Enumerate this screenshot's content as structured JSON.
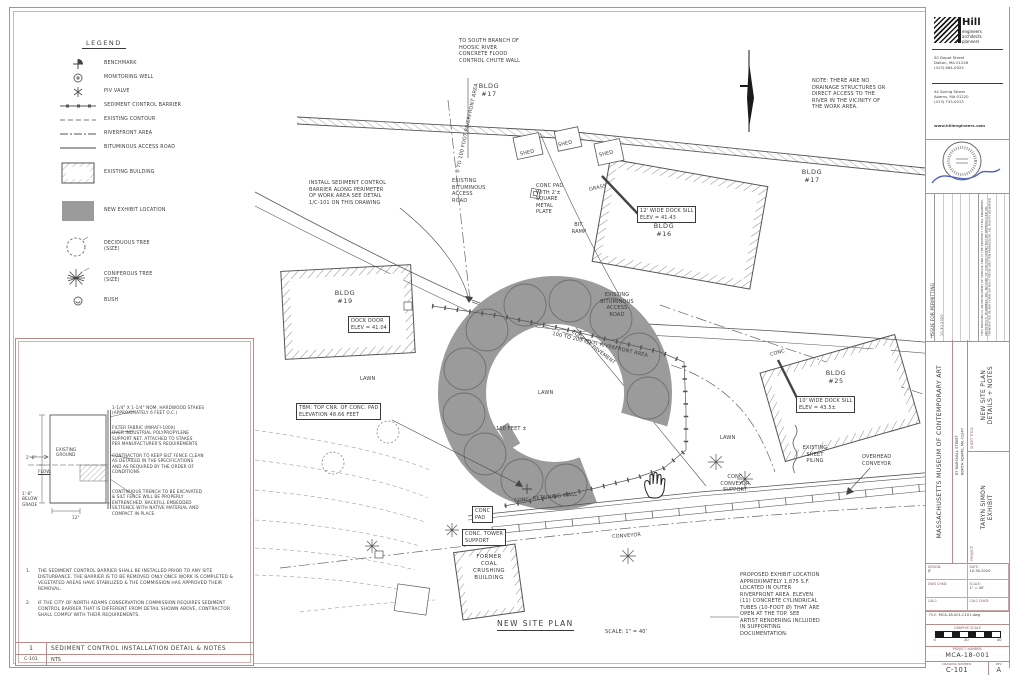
{
  "colors": {
    "frame": "#b98c8c",
    "ink": "#3c3c3c",
    "exhibit_gray": "#9b9b9b",
    "signature_blue": "#4a5fc1"
  },
  "legend": {
    "title": "LEGEND",
    "items": [
      {
        "icon": "benchmark-icon",
        "label": "BENCHMARK"
      },
      {
        "icon": "monitoring-well-icon",
        "label": "MONITORING WELL"
      },
      {
        "icon": "piv-valve-icon",
        "label": "PIV VALVE"
      },
      {
        "icon": "sediment-barrier-icon",
        "label": "SEDIMENT CONTROL BARRIER"
      },
      {
        "icon": "existing-contour-icon",
        "label": "EXISTING CONTOUR"
      },
      {
        "icon": "riverfront-area-icon",
        "label": "RIVERFRONT AREA"
      },
      {
        "icon": "bituminous-road-icon",
        "label": "BITUMINOUS ACCESS ROAD"
      },
      {
        "icon": "existing-building-icon",
        "label": "EXISTING BUILDING"
      },
      {
        "icon": "new-exhibit-icon",
        "label": "NEW EXHIBIT LOCATION"
      },
      {
        "icon": "deciduous-tree-icon",
        "label": "DECIDUOUS TREE\n(SIZE)"
      },
      {
        "icon": "coniferous-tree-icon",
        "label": "CONIFEROUS TREE\n(SIZE)"
      },
      {
        "icon": "bush-icon",
        "label": "BUSH"
      }
    ]
  },
  "plan": {
    "labels": [
      {
        "t": "TO SOUTH BRANCH OF\nHOOSIC RIVER\nCONCRETE FLOOD\nCONTROL CHUTE WALL"
      },
      {
        "t": "BLDG\n#17"
      },
      {
        "t": "NOTE: THERE ARE NO\nDRAINAGE STRUCTURES OR\nDIRECT ACCESS TO THE\nRIVER IN THE VICINITY OF\nTHE WORK AREA."
      },
      {
        "t": "BLDG\n#17"
      },
      {
        "t": "INSTALL SEDIMENT CONTROL\nBARRIER ALONG PERIMETER\nOF WORK AREA SEE DETAIL\n1/C-101 ON THIS DRAWING"
      },
      {
        "t": "0 TO 100 FOOT RIVERFRONT AREA"
      },
      {
        "t": "EXISTING\nBITUMINOUS\nACCESS\nROAD"
      },
      {
        "t": "SHED"
      },
      {
        "t": "SHED"
      },
      {
        "t": "SHED"
      },
      {
        "t": "CONC PAD\nWITH 2'±\nSQUARE\nMETAL\nPLATE"
      },
      {
        "t": "GRASS"
      },
      {
        "t": "BIT.\nRAMP"
      },
      {
        "t": "12' WIDE DOCK SILL\nELEV = 41.43"
      },
      {
        "t": "BLDG\n#16"
      },
      {
        "t": "EXISTING\nBITUMINOUS\nACCESS\nROAD"
      },
      {
        "t": "100 TO 200 FOOT RIVERFRONT AREA"
      },
      {
        "t": "BLDG\n#19"
      },
      {
        "t": "DOCK DOOR\nELEV = 41.04"
      },
      {
        "t": "LAWN"
      },
      {
        "t": "LAWN"
      },
      {
        "t": "LAWN"
      },
      {
        "t": "EDGE OF PAVEMENT"
      },
      {
        "t": "TBM: TOP CNR. OF CONC. PAD\nELEVATION 48.66 FEET"
      },
      {
        "t": "110 FEET ±"
      },
      {
        "t": "CONC"
      },
      {
        "t": "BLDG\n#25"
      },
      {
        "t": "10' WIDE DOCK SILL\nELEV = 43.5±"
      },
      {
        "t": "EXISTING\nSHEET\nPILING"
      },
      {
        "t": "OVERHEAD\nCONVEYOR"
      },
      {
        "t": "CONC\nCONVEYOR\nSUPPORT"
      },
      {
        "t": "CONC. RETAINING WALL"
      },
      {
        "t": "CONC\nPAD"
      },
      {
        "t": "CONC. TOWER\nSUPPORT"
      },
      {
        "t": "FORMER\nCOAL\nCRUSHING\nBUILDING"
      },
      {
        "t": "CONVEYOR"
      },
      {
        "t": "NEW SITE PLAN"
      },
      {
        "t": "SCALE: 1\" = 40'"
      },
      {
        "t": "PROPOSED EXHIBIT LOCATION\nAPPROXIMATELY 1,875 S.F.\nLOCATED IN OUTER\nRIVERFRONT AREA. ELEVEN\n(11) CONCRETE CYLINDRICAL\nTUBES (10-FOOT Ø) THAT ARE\nOPEN AT THE TOP.  SEE\nARTIST RENDERING INCLUDED\nIN SUPPORTING\nDOCUMENTATION."
      }
    ]
  },
  "detail": {
    "callouts": [
      {
        "t": "1-1/4\" X 1-1/4\" NOM. HARDWOOD STAKES\n(APPROXIMATELY 6 FEET O.C.)"
      },
      {
        "t": "FILTER FABRIC (MIRAFI-100X)\nOVER INDUSTRIAL POLYPROPYLENE\nSUPPORT NET. ATTACHED TO STAKES\nPER MANUFACTURER'S REQUIREMENTS"
      },
      {
        "t": "CONTRACTOR TO KEEP SILT FENCE CLEAN\nAS DETAILED IN THE SPECIFICATIONS\nAND AS REQUIRED BY THE ORDER OF\nCONDITIONS"
      },
      {
        "t": "CONTINUOUS TRENCH TO BE EXCAVATED\n& SILT FENCE WILL BE PROPERLY\nENTRENCHED. BACKFILL EMBEDDED\nSILTFENCE WITH NATIVE MATERIAL AND\nCOMPACT IN PLACE."
      }
    ],
    "dims": {
      "height": "2'-6\"",
      "existing_ground": "EXISTING\nGROUND",
      "flow": "FLOW",
      "below_grade": "1'-6\"\nBELOW\nGRADE",
      "width": "12\""
    },
    "notes": [
      {
        "n": "1.",
        "t": "THE SEDIMENT CONTROL BARRIER SHALL BE INSTALLED PRIOR TO ANY SITE DISTURBANCE.  THE BARRIER IS TO BE REMOVED ONLY ONCE WORK IS COMPLETED & VEGETATED AREAS HAVE STABILIZED & THE COMMISSION HAS APPROVED THEIR REMOVAL."
      },
      {
        "n": "2.",
        "t": "IF THE CITY OF NORTH ADAMS CONSERVATION COMMISSION REQUIRES SEDIMENT CONTROL BARRIER THAT IS DIFFERENT FROM DETAIL SHOWN ABOVE, CONTRACTOR SHALL COMPLY WITH THEIR REQUIREMENTS."
      }
    ],
    "footer": {
      "number": "1",
      "title": "SEDIMENT CONTROL INSTALLATION DETAIL & NOTES",
      "ref": "C-101",
      "scale": "NTS"
    }
  },
  "titleblock": {
    "firm": {
      "name": "Hill",
      "tagline": "engineers\narchitects\nplanners",
      "address1": "50 Depot Street\nDalton, MA 01226\n(413) 684-0925",
      "address2": "44 Spring Street\nAdams, MA 01220\n(413) 743-0013",
      "website": "www.hillengineers.com"
    },
    "revisions": {
      "number": "1",
      "date": "10-30-2020",
      "description": "ISSUE FOR PERMITTING",
      "fine_print": "THIS DRAWING IS AN INSTRUMENT OF SERVICE AND IS THE PROPERTY OF HILL ENGINEERS, ARCHITECTS, PLANNERS, INC. NO PART OF THIS DOCUMENT MAY BE REPRODUCED OR TRANSMITTED IN ANY FORM WITHOUT PRIOR WRITTEN PERMISSION. ALL RIGHTS RESERVED."
    },
    "client": {
      "name": "MASSACHUSETTS MUSEUM OF CONTEMPORARY ART",
      "address": "87 MARSHALL STREET\nNORTH ADAMS, MA 01247"
    },
    "sheet": {
      "label": "SHEET TITLE:",
      "title": "NEW SITE PLAN\nDETAILS + NOTES"
    },
    "project": {
      "label": "PROJECT:",
      "title": "TARYN SIMON\nEXHIBIT"
    },
    "fields": [
      {
        "label": "DESIGN:",
        "value": "JF"
      },
      {
        "label": "DATE:",
        "value": "10-30-2020"
      },
      {
        "label": "DWG CHKD:",
        "value": ""
      },
      {
        "label": "SCALE:",
        "value": "1\" = 40'"
      },
      {
        "label": "CALC:",
        "value": ""
      },
      {
        "label": "CALC CHKD:",
        "value": ""
      }
    ],
    "file": {
      "label": "FILE:",
      "value": "MCA-18-001-C101.dwg"
    },
    "graphic_scale": {
      "label": "GRAPHIC SCALE",
      "ticks": [
        "0",
        "20",
        "40"
      ]
    },
    "project_number": {
      "label": "PROJECT NUMBER:",
      "value": "MCA-18-001"
    },
    "drawing_number": {
      "label": "DRAWING NUMBER:",
      "value": "C-101",
      "rev_label": "REV:",
      "rev": "A"
    }
  }
}
